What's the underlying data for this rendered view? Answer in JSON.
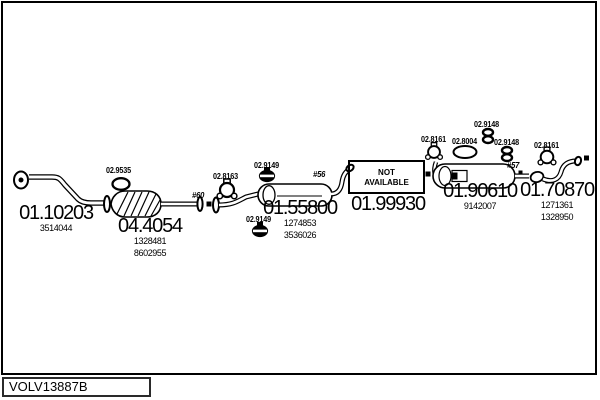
{
  "drawing": {
    "code": "VOLV13887B",
    "not_available_line1": "NOT",
    "not_available_line2": "AVAILABLE",
    "ink_color": "#000000",
    "paper_color": "#ffffff"
  },
  "parts": [
    {
      "id": "front-pipe",
      "number": "01.10203",
      "oe": [
        "3514044"
      ]
    },
    {
      "id": "catalyst",
      "number": "04.4054",
      "oe": [
        "1328481",
        "8602955"
      ]
    },
    {
      "id": "centre-silencer",
      "number": "01.55800",
      "oe": [
        "1274853",
        "3536026"
      ]
    },
    {
      "id": "over-axle-pipe",
      "number": "01.99930",
      "oe": []
    },
    {
      "id": "rear-silencer",
      "number": "01.90610",
      "oe": [
        "9142007"
      ]
    },
    {
      "id": "tail-pipe",
      "number": "01.70870",
      "oe": [
        "1271361",
        "1328950"
      ]
    }
  ],
  "fittings": [
    {
      "number": "02.9535",
      "icon": "gasket-ring"
    },
    {
      "number": "02.8163",
      "icon": "pipe-clamp"
    },
    {
      "number": "02.9149",
      "icon": "band-clamp"
    },
    {
      "number": "02.9149",
      "icon": "band-clamp"
    },
    {
      "number": "02.8161",
      "icon": "pipe-clamp"
    },
    {
      "number": "02.8004",
      "icon": "gasket-ring"
    },
    {
      "number": "02.9148",
      "icon": "double-ring-seal"
    },
    {
      "number": "02.9148",
      "icon": "double-ring-seal"
    },
    {
      "number": "02.8161",
      "icon": "pipe-clamp"
    }
  ],
  "dimensions": [
    "#60",
    "#56",
    "#57"
  ]
}
